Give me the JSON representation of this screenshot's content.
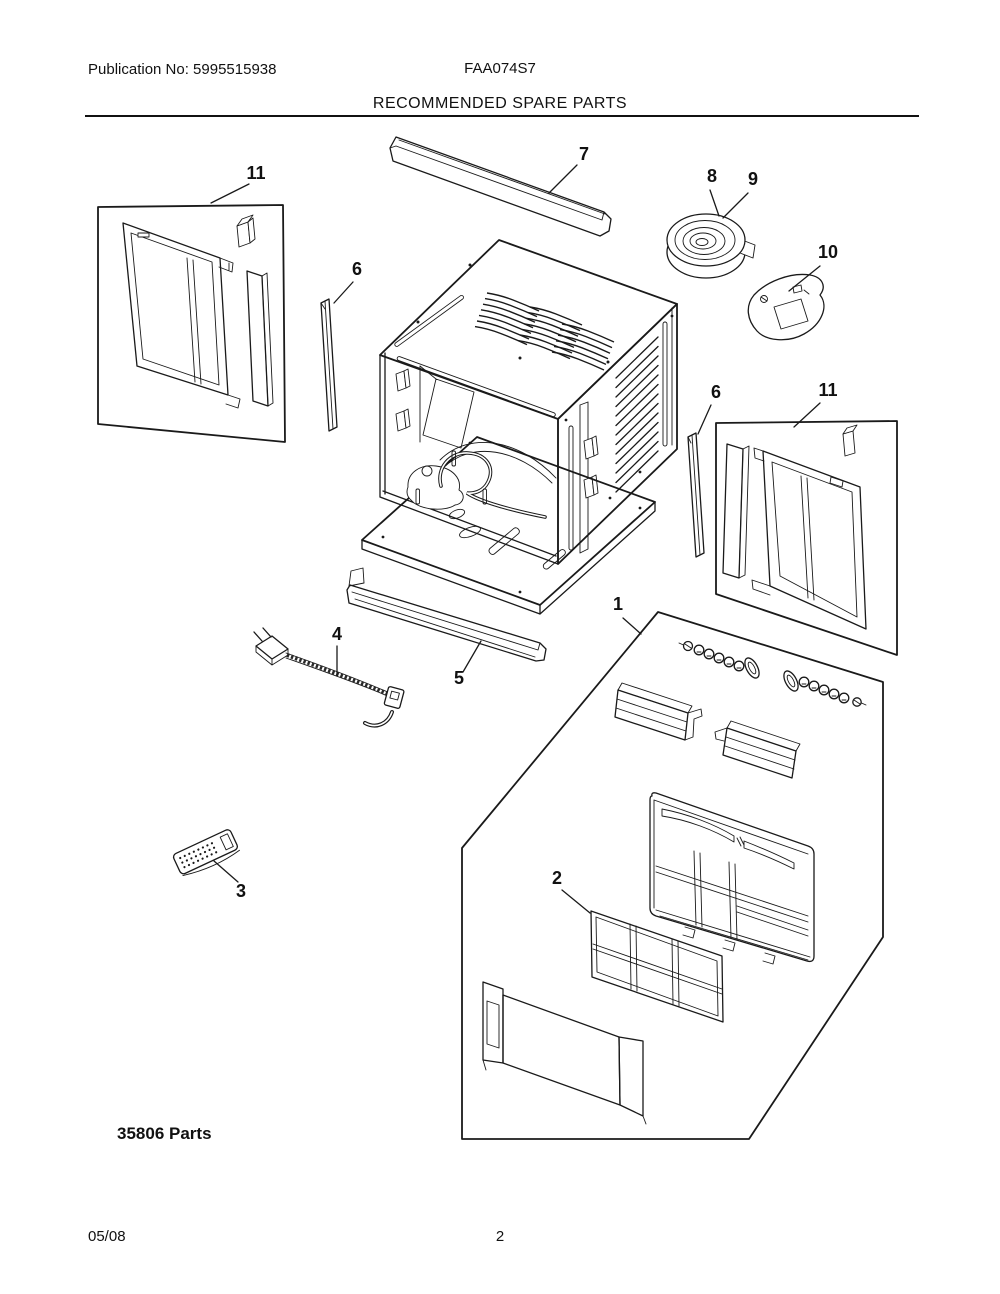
{
  "header": {
    "publication_no": "Publication No: 5995515938",
    "model": "FAA074S7",
    "title": "RECOMMENDED SPARE PARTS"
  },
  "diagram": {
    "parts_note": "35806 Parts",
    "callouts": {
      "window_panel_left": "11",
      "top_rail": "7",
      "foam_seal_8": "8",
      "foam_seal_9": "9",
      "bracket": "10",
      "side_strip_left": "6",
      "side_strip_right": "6",
      "window_panel_right": "11",
      "front_assembly": "1",
      "bottom_rail": "5",
      "power_cord": "4",
      "remote_control": "3",
      "filter": "2"
    }
  },
  "footer": {
    "date": "05/08",
    "page_number": "2"
  }
}
